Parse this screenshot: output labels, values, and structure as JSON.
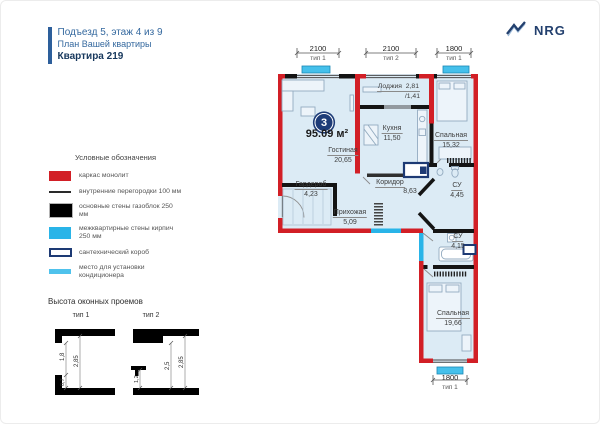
{
  "header": {
    "building_line": "Подъезд 5, этаж 4 из 9",
    "plan_line": "План Вашей квартиры",
    "apartment_line": "Квартира 219"
  },
  "logo": {
    "text": "NRG"
  },
  "legend": {
    "title": "Условные обозначения",
    "items": [
      {
        "label": "каркас монолит"
      },
      {
        "label": "внутренние перегородки 100 мм"
      },
      {
        "label": "основные стены газоблок 250 мм"
      },
      {
        "label": "межквартирные стены кирпич 250 мм"
      },
      {
        "label": "сантехнический короб"
      },
      {
        "label": "место для установки кондиционера"
      }
    ]
  },
  "window_heights": {
    "title": "Высота оконных проемов",
    "type1": {
      "label": "тип 1",
      "window": "1,8",
      "total": "2,85",
      "parapet": "0,7"
    },
    "type2": {
      "label": "тип 2",
      "ledge": "1,2",
      "window": "2,5",
      "total": "2,85"
    }
  },
  "plan": {
    "rooms_badge": "3",
    "total_area": "95.09 м²",
    "rooms": {
      "living": {
        "name": "Гостиная",
        "area": "20,65"
      },
      "kitchen": {
        "name": "Кухня",
        "area": "11,50"
      },
      "loggia": {
        "name": "Лоджия",
        "area": "2,81",
        "area_alt": "/1,41"
      },
      "bedroom1": {
        "name": "Спальная",
        "area": "15,32"
      },
      "wardrobe": {
        "name": "Гардероб",
        "area": "4,23"
      },
      "corridor": {
        "name": "Коридор",
        "area": "8,63"
      },
      "hallway": {
        "name": "Прихожая",
        "area": "5,09"
      },
      "bathroom1": {
        "name": "СУ",
        "area": "4,45"
      },
      "bathroom2": {
        "name": "СУ",
        "area": "4,15"
      },
      "bedroom2": {
        "name": "Спальная",
        "area": "19,66"
      }
    },
    "windows": {
      "top1": {
        "width": "2100",
        "type": "тип 1"
      },
      "top2": {
        "width": "2100",
        "type": "тип 2"
      },
      "top3": {
        "width": "1800",
        "type": "тип 1"
      },
      "bottom": {
        "width": "1800",
        "type": "тип 1"
      }
    }
  },
  "colors": {
    "accent_red": "#d21f26",
    "wall_black": "#141414",
    "brick_cyan": "#29b4e8",
    "ac_cyan": "#45c0eb",
    "sanitary_navy": "#1d3a74",
    "room_fill": "#dcebf5",
    "header_blue": "#35699f",
    "header_navy": "#16375c"
  }
}
